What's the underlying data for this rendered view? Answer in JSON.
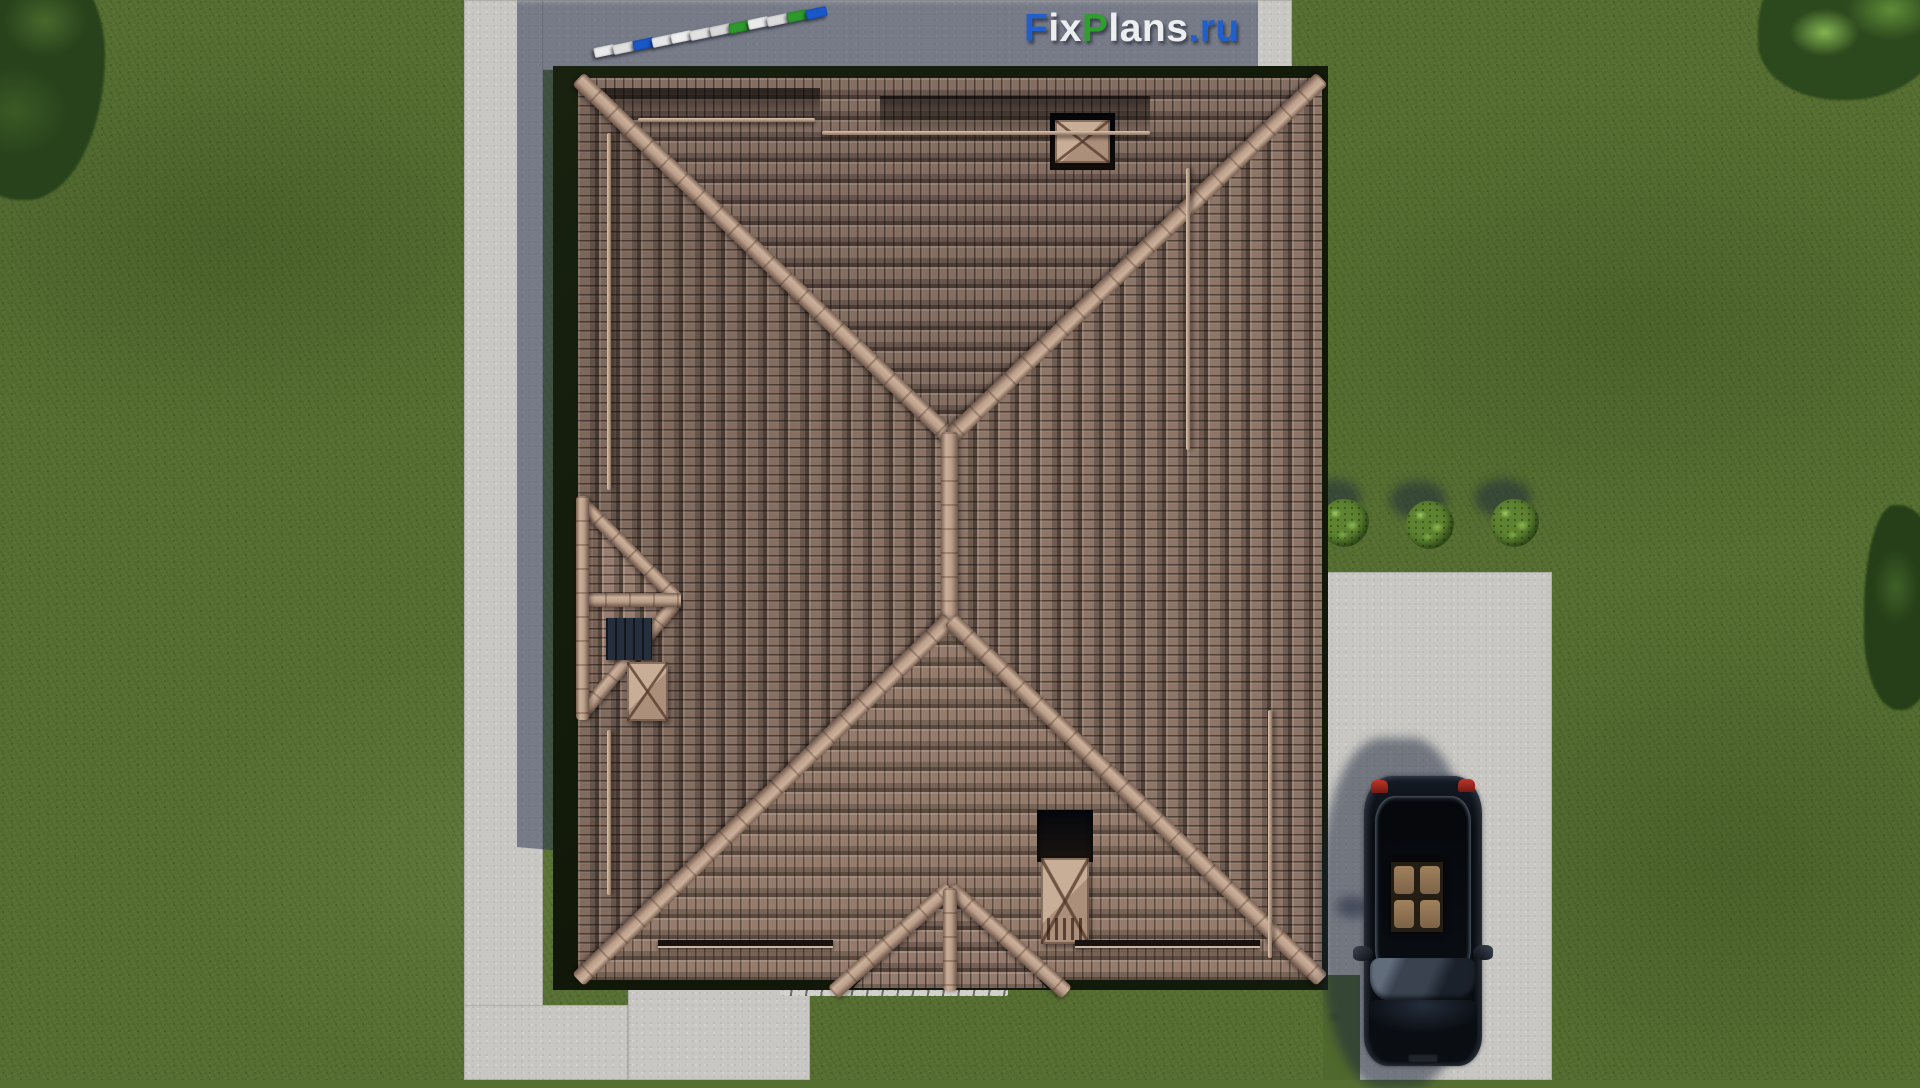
{
  "watermark": {
    "text": "FixPlans.ru",
    "segments": [
      {
        "text": "F",
        "color": "#2160cc"
      },
      {
        "text": "ix",
        "color": "#eceef0"
      },
      {
        "text": "P",
        "color": "#2f9e2d"
      },
      {
        "text": "lans",
        "color": "#eceef0"
      },
      {
        "text": ".ru",
        "color": "#2160cc"
      }
    ]
  },
  "scene": {
    "description": "Top-down aerial 3D render of a hip-roof house with brown barrel tiles, concrete paths, lawn, three bushes and a black car on the driveway",
    "roof": {
      "tile_color": "#8d7568",
      "ridge_color": "#bb9f8a",
      "edge_band_color": "#131b0c",
      "chimney_count": 3,
      "snow_guards": true
    },
    "ground": {
      "grass_color": "#566f31",
      "path_color": "#c8c7c3",
      "driveway_color": "#c8c7c3",
      "shadow_color": "#2c3552",
      "gravel_strip": true
    },
    "bushes": [
      {
        "x": 1345,
        "y": 523,
        "r": 24
      },
      {
        "x": 1430,
        "y": 525,
        "r": 24
      },
      {
        "x": 1515,
        "y": 523,
        "r": 24
      }
    ],
    "car": {
      "body_color": "#0a0d13",
      "taillight_color": "#b23028",
      "interior_color": "#8f7658",
      "x": 1358,
      "y": 770,
      "width": 130,
      "height": 300
    },
    "letter_tiles": {
      "comment": "3D standing letters of watermark seen from above, diagonal row on north path",
      "x0": 594,
      "y0": 46,
      "x1": 806,
      "y1": 8,
      "colors": [
        "#e9e9e9",
        "#dedede",
        "#1a57c8",
        "#e6e6e6",
        "#efefef",
        "#e2e2e2",
        "#d9d9d9",
        "#2d9a2b",
        "#eaeaea",
        "#dcdcdc",
        "#2d9a2b",
        "#1a57c8"
      ]
    }
  }
}
